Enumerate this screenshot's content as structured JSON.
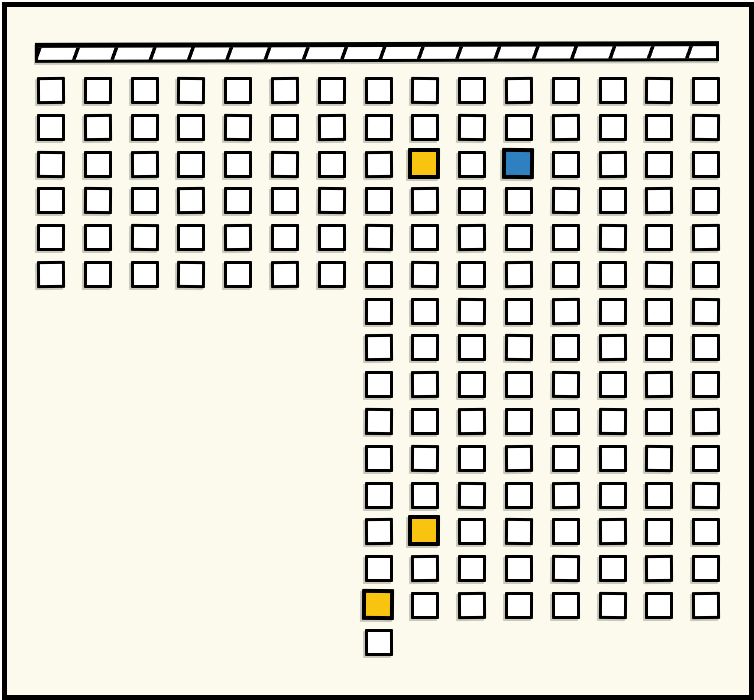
{
  "canvas": {
    "width": 754,
    "height": 700,
    "background": "#FCFAEC",
    "frame_border_color": "#000000"
  },
  "board_bar": {
    "description": "horizontal bar with diagonal black hatching at top of diagram",
    "fill": "#FFFFFF",
    "stripe_color": "#000000",
    "stripe_pitch_px": 36
  },
  "grid": {
    "origin_x": 30,
    "origin_y": 70,
    "col_pitch": 46.8,
    "row_pitch": 36.78,
    "cell_outer_w": 28,
    "cell_outer_h": 27,
    "columns_total": 15,
    "rows_total": 16,
    "cells_total": 163,
    "blocks": [
      {
        "name": "upper-left-block",
        "col_start": 0,
        "col_end": 6,
        "row_start": 0,
        "row_end": 5
      },
      {
        "name": "right-tall-block",
        "col_start": 7,
        "col_end": 14,
        "row_start": 0,
        "row_end": 14
      },
      {
        "name": "bottom-extra-cell",
        "col_start": 7,
        "col_end": 7,
        "row_start": 15,
        "row_end": 15
      }
    ],
    "highlighted": [
      {
        "row": 2,
        "col": 8,
        "state": "yellow"
      },
      {
        "row": 2,
        "col": 10,
        "state": "blue"
      },
      {
        "row": 12,
        "col": 8,
        "state": "yellow"
      },
      {
        "row": 14,
        "col": 7,
        "state": "yellow"
      }
    ],
    "colors": {
      "empty_fill": "#FFFFFF",
      "yellow": "#F9C40F",
      "blue": "#2E80C1",
      "border": "#000000"
    }
  }
}
